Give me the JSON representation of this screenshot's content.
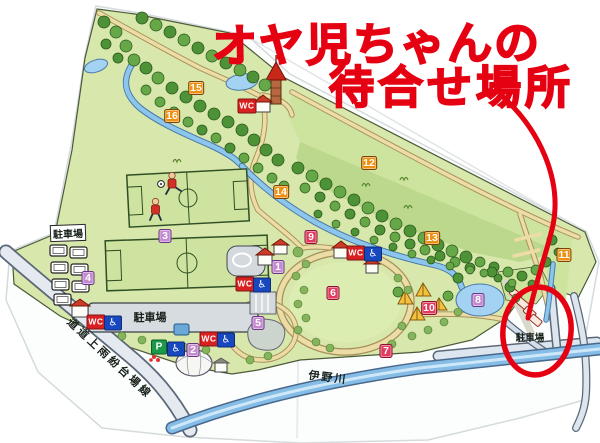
{
  "annotation": {
    "title_lines": [
      "オヤ児ちゃんの",
      "待合せ場所"
    ],
    "ink_color": "#e50012"
  },
  "map": {
    "palette": {
      "orange": "#ef8f0e",
      "crimson": "#e23a5e",
      "purple": "#c38ad0",
      "wc": "#d92020",
      "accessible": "#1848c0",
      "parking_p": "#1a9a48"
    },
    "markers": [
      {
        "label": "1",
        "color": "purple",
        "x": 278,
        "y": 267
      },
      {
        "label": "2",
        "color": "purple",
        "x": 193,
        "y": 350
      },
      {
        "label": "3",
        "color": "purple",
        "x": 165,
        "y": 236
      },
      {
        "label": "4",
        "color": "purple",
        "x": 88,
        "y": 278
      },
      {
        "label": "5",
        "color": "purple",
        "x": 258,
        "y": 323
      },
      {
        "label": "6",
        "color": "crimson",
        "x": 333,
        "y": 293
      },
      {
        "label": "7",
        "color": "crimson",
        "x": 386,
        "y": 351
      },
      {
        "label": "8",
        "color": "purple",
        "x": 478,
        "y": 300
      },
      {
        "label": "9",
        "color": "crimson",
        "x": 311,
        "y": 237
      },
      {
        "label": "10",
        "color": "crimson",
        "x": 429,
        "y": 308
      },
      {
        "label": "11",
        "color": "orange",
        "x": 564,
        "y": 255
      },
      {
        "label": "12",
        "color": "orange",
        "x": 369,
        "y": 163
      },
      {
        "label": "13",
        "color": "orange",
        "x": 432,
        "y": 238
      },
      {
        "label": "14",
        "color": "orange",
        "x": 281,
        "y": 192
      },
      {
        "label": "15",
        "color": "orange",
        "x": 196,
        "y": 88
      },
      {
        "label": "16",
        "color": "orange",
        "x": 172,
        "y": 116
      }
    ],
    "facilities": [
      {
        "type": "wc",
        "label": "WC",
        "x": 247,
        "y": 106
      },
      {
        "type": "wc",
        "label": "WC",
        "x": 245,
        "y": 284
      },
      {
        "type": "accessible",
        "label": "♿",
        "x": 262,
        "y": 285
      },
      {
        "type": "wc",
        "label": "WC",
        "x": 356,
        "y": 253
      },
      {
        "type": "accessible",
        "label": "♿",
        "x": 373,
        "y": 254
      },
      {
        "type": "wc",
        "label": "WC",
        "x": 96,
        "y": 322
      },
      {
        "type": "accessible",
        "label": "♿",
        "x": 113,
        "y": 323
      },
      {
        "type": "wc",
        "label": "WC",
        "x": 209,
        "y": 339
      },
      {
        "type": "accessible",
        "label": "♿",
        "x": 226,
        "y": 340
      },
      {
        "type": "parking",
        "label": "P",
        "x": 159,
        "y": 347
      },
      {
        "type": "accessible",
        "label": "♿",
        "x": 176,
        "y": 349
      }
    ],
    "labels": [
      {
        "text": "駐車場",
        "x": 68,
        "y": 233,
        "size": 10,
        "rot": -2,
        "chip": true
      },
      {
        "text": "駐車場",
        "x": 150,
        "y": 317,
        "size": 11,
        "rot": 0
      },
      {
        "text": "駐車場",
        "x": 530,
        "y": 337,
        "size": 9.5,
        "rot": 0
      },
      {
        "text": "道道上雨紛台場線",
        "x": 110,
        "y": 358,
        "size": 11,
        "rot": 43,
        "spacing": 3
      },
      {
        "text": "伊野川",
        "x": 328,
        "y": 377,
        "size": 11,
        "rot": 7,
        "spacing": 2
      }
    ]
  }
}
